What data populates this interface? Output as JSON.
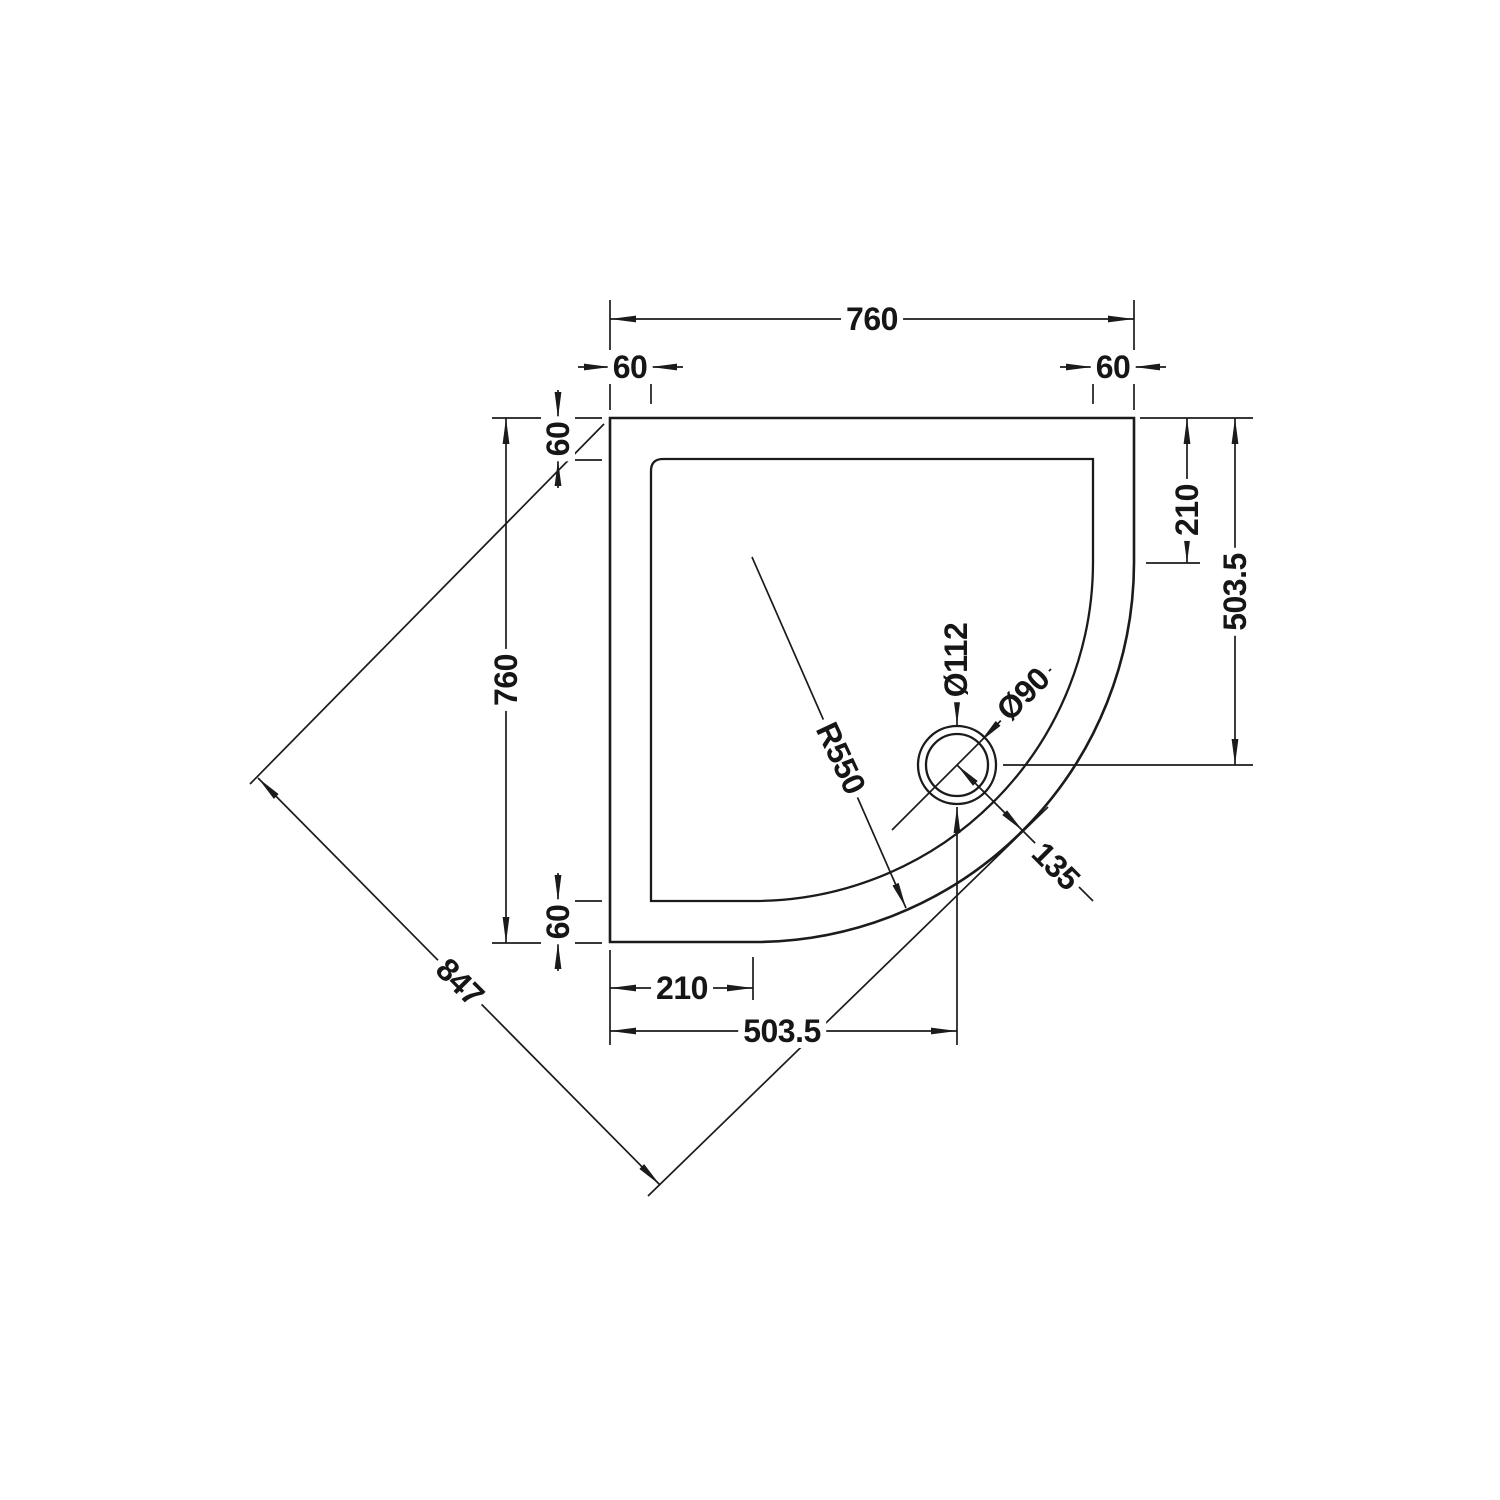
{
  "drawing": {
    "background": "#ffffff",
    "line_color": "#1b1b1b"
  },
  "dims": {
    "top_width": "760",
    "top_left_flange": "60",
    "top_right_flange": "60",
    "left_height": "760",
    "left_top_flange": "60",
    "left_bottom_flange": "60",
    "bottom_straight_edge": "210",
    "bottom_drain_offset": "503.5",
    "right_straight_edge": "210",
    "right_drain_offset": "503.5",
    "diagonal_length": "847",
    "corner_radius": "R550",
    "waste_outer_dia": "Ø112",
    "waste_inner_dia": "Ø90",
    "drain_to_edge": "135"
  }
}
